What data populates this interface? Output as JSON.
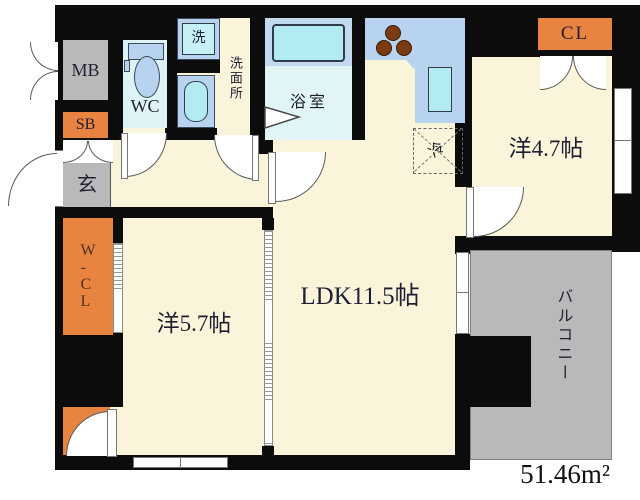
{
  "labels": {
    "meter_box": "MB",
    "shoe_box": "SB",
    "entrance": "玄",
    "toilet": "WC",
    "laundry": "洗",
    "washroom": "洗面所",
    "bathroom": "浴室",
    "refrigerator": "冷",
    "closet": "CL",
    "walk_in_closet": "W\n-\nC\nL",
    "western_room_47": "洋4.7帖",
    "western_room_57": "洋5.7帖",
    "ldk": "LDK11.5帖",
    "balcony": "バルコニー",
    "total_area": "51.46m²"
  },
  "colors": {
    "wall": "#0c0c0c",
    "floor": "#faf5da",
    "orange": "#e98340",
    "gray": "#b9b9b9",
    "fixture": "#b7d3ef",
    "water": "#b3ebf3",
    "bath-floor": "#e1f5f6",
    "wc-floor": "#ddf3f6",
    "burner": "#7b3b10",
    "label": "#1f1f33"
  }
}
